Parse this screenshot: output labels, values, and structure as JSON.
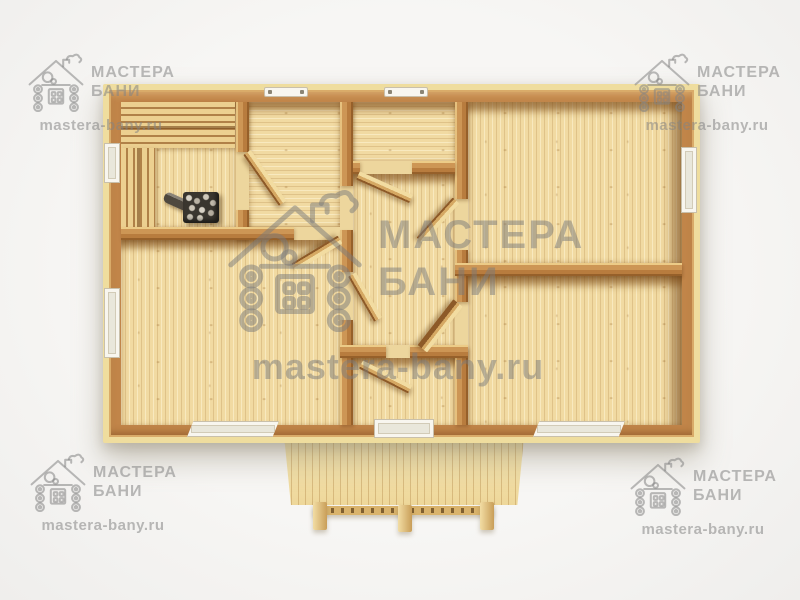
{
  "watermarks": {
    "brand_line1": "МАСТЕРА",
    "brand_line2": "БАНИ",
    "url": "mastera-bany.ru",
    "logo": "log-cabin-icon",
    "color": "#8a8a8a"
  },
  "palette": {
    "page_background": "#f4f3f1",
    "wall_outer_edge": "#efdd9e",
    "wall_top": "#c18549",
    "wall_shadow": "#96602a",
    "floor_light": "#f1daa2",
    "floor_seam": "#a5763a",
    "bench_slat": "#ecd090",
    "bench_gap": "#b08148",
    "door_wood": "#e9c98b",
    "stove_body": "#3a362f",
    "stove_stones": "#cfc8ba",
    "window_frame": "#f8f6ef",
    "porch_deck": "#f6e7b4"
  }
}
